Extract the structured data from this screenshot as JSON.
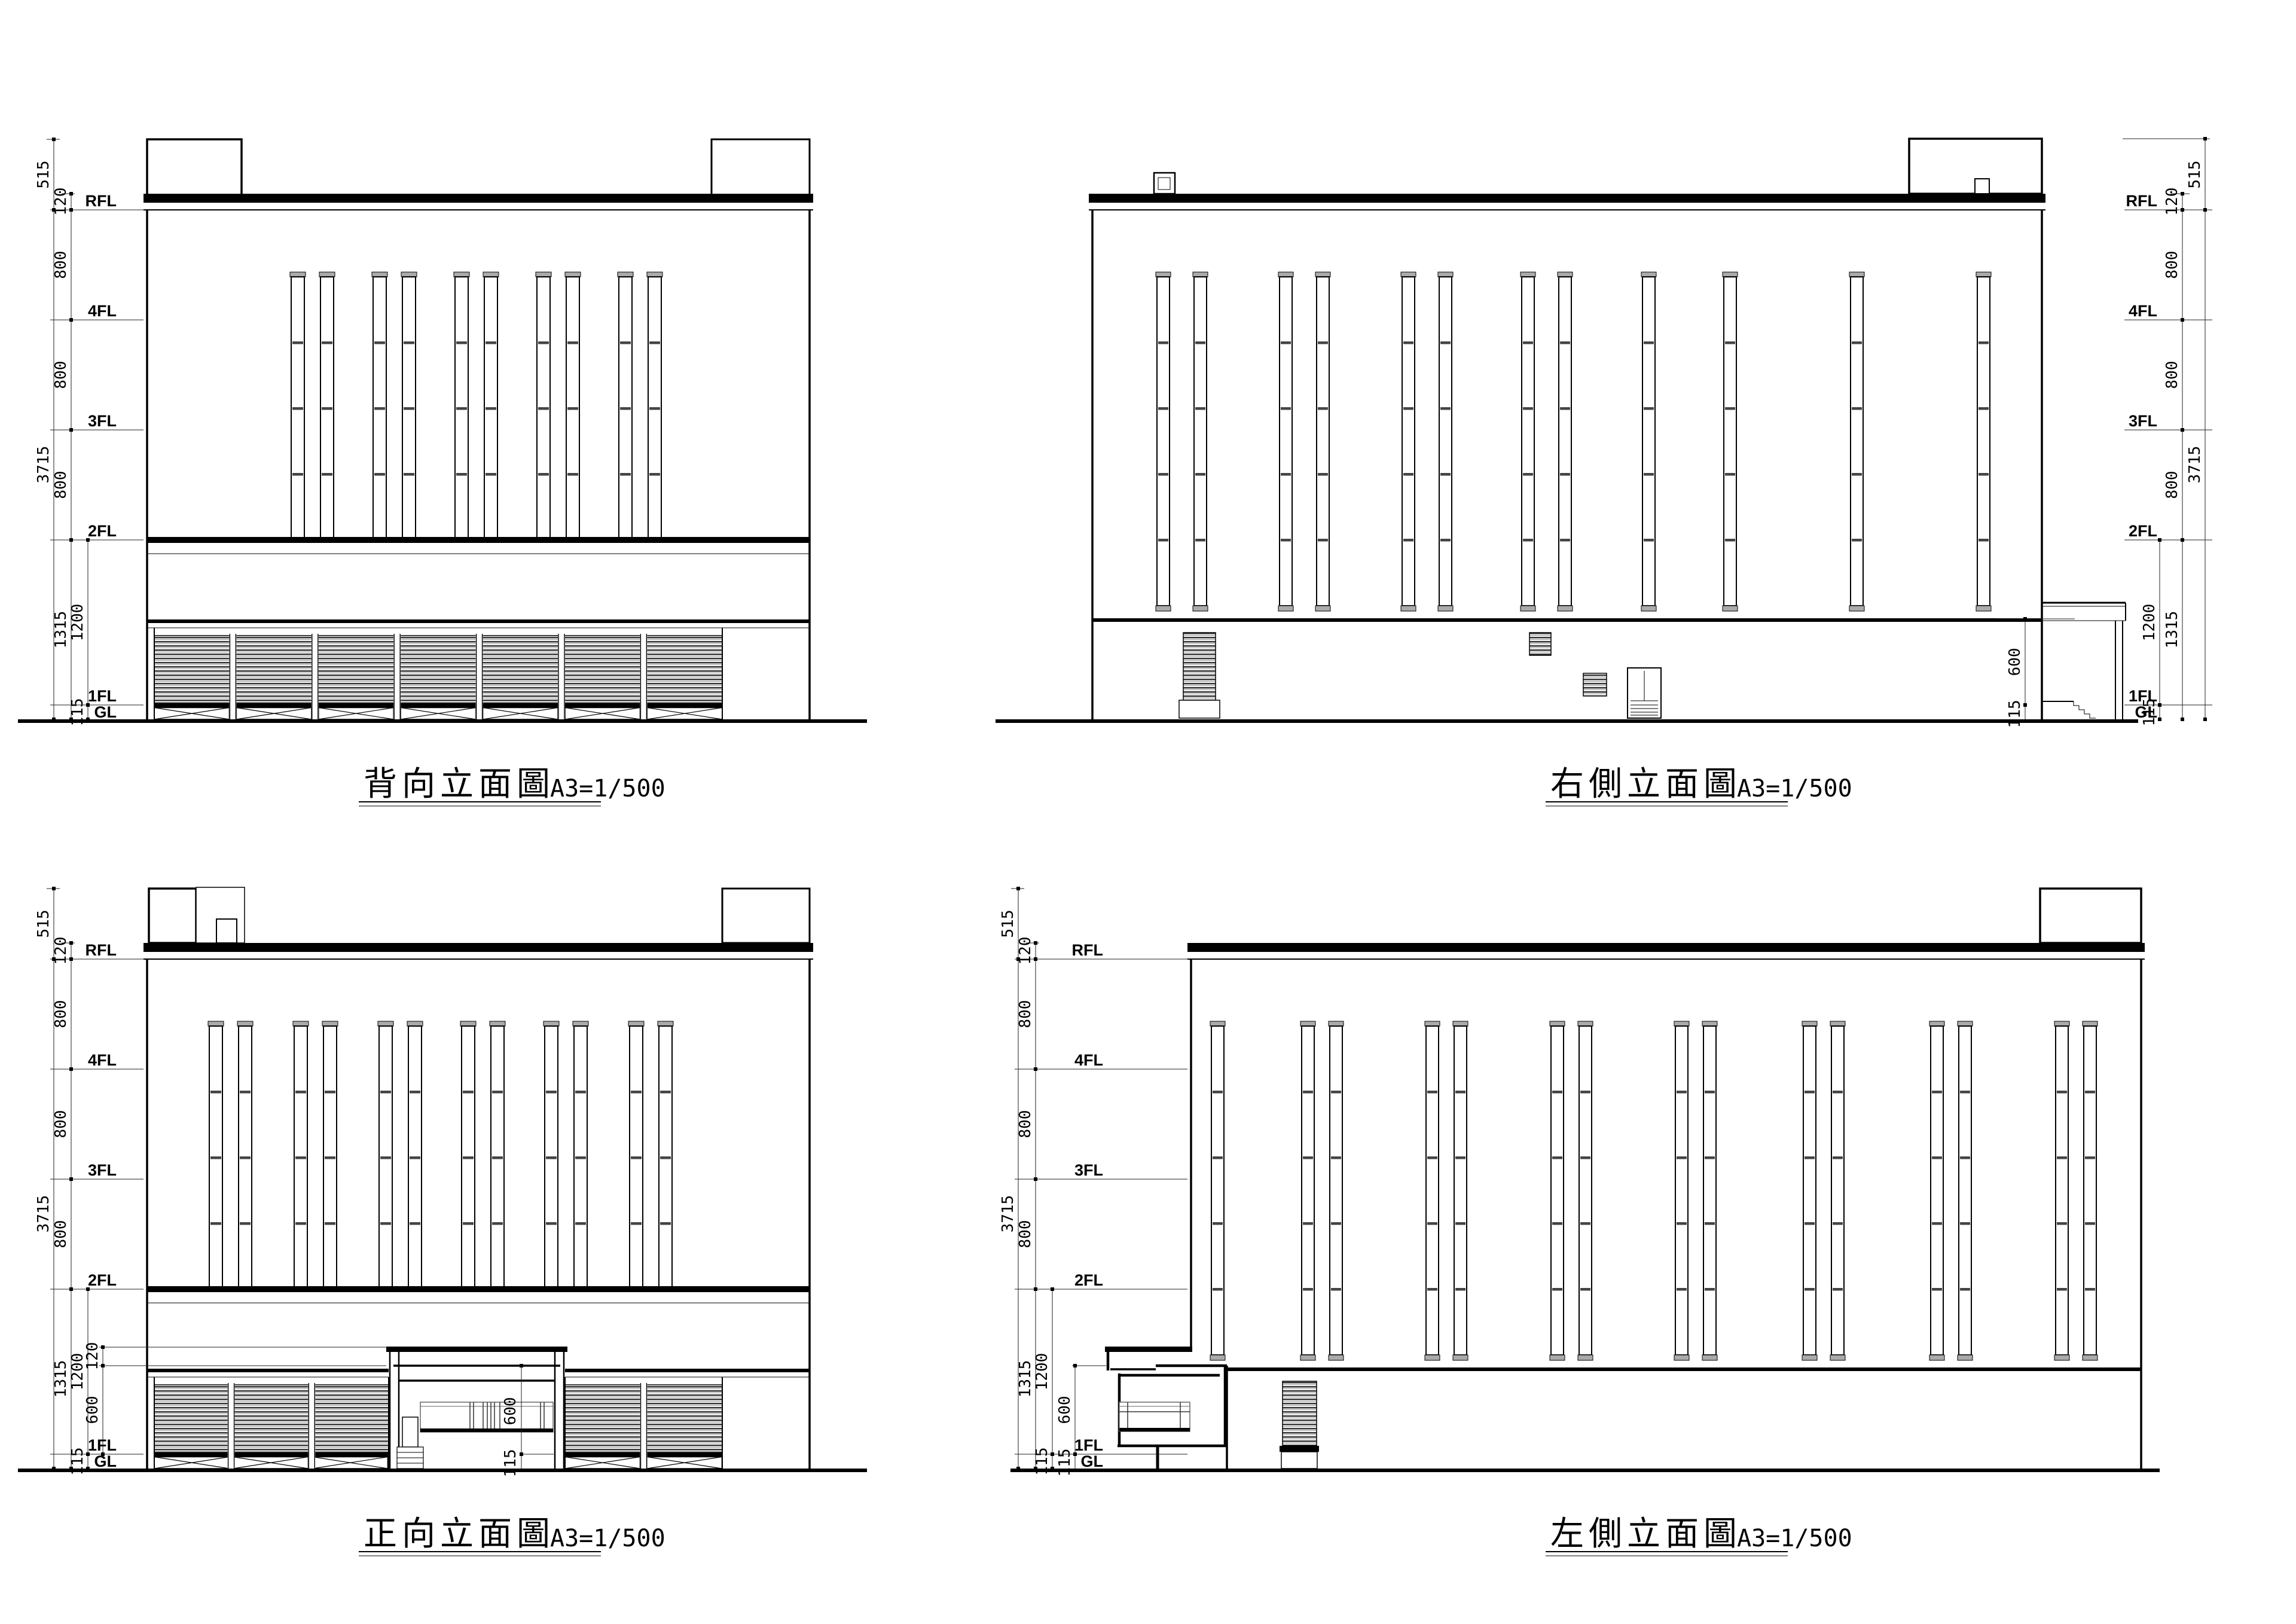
{
  "page": {
    "background": "#ffffff",
    "ink": "#000000",
    "louver_fill": "#555555",
    "cap_fill": "#aaaaaa"
  },
  "common": {
    "floor_labels": [
      "RFL",
      "4FL",
      "3FL",
      "2FL",
      "1FL",
      "GL"
    ],
    "dims": {
      "parapet": "515",
      "roof_edge": "120",
      "storey": "800",
      "total": "3715",
      "lower_zone": "1315",
      "first_storey": "1200",
      "plinth": "115",
      "canopy_clear": "600",
      "canopy_slab": "120"
    },
    "scale_label": "A3=1/500"
  },
  "drawings": [
    {
      "id": "rear",
      "title": "背向立面圖"
    },
    {
      "id": "right",
      "title": "右側立面圖"
    },
    {
      "id": "front",
      "title": "正向立面圖"
    },
    {
      "id": "left",
      "title": "左側立面圖"
    }
  ]
}
